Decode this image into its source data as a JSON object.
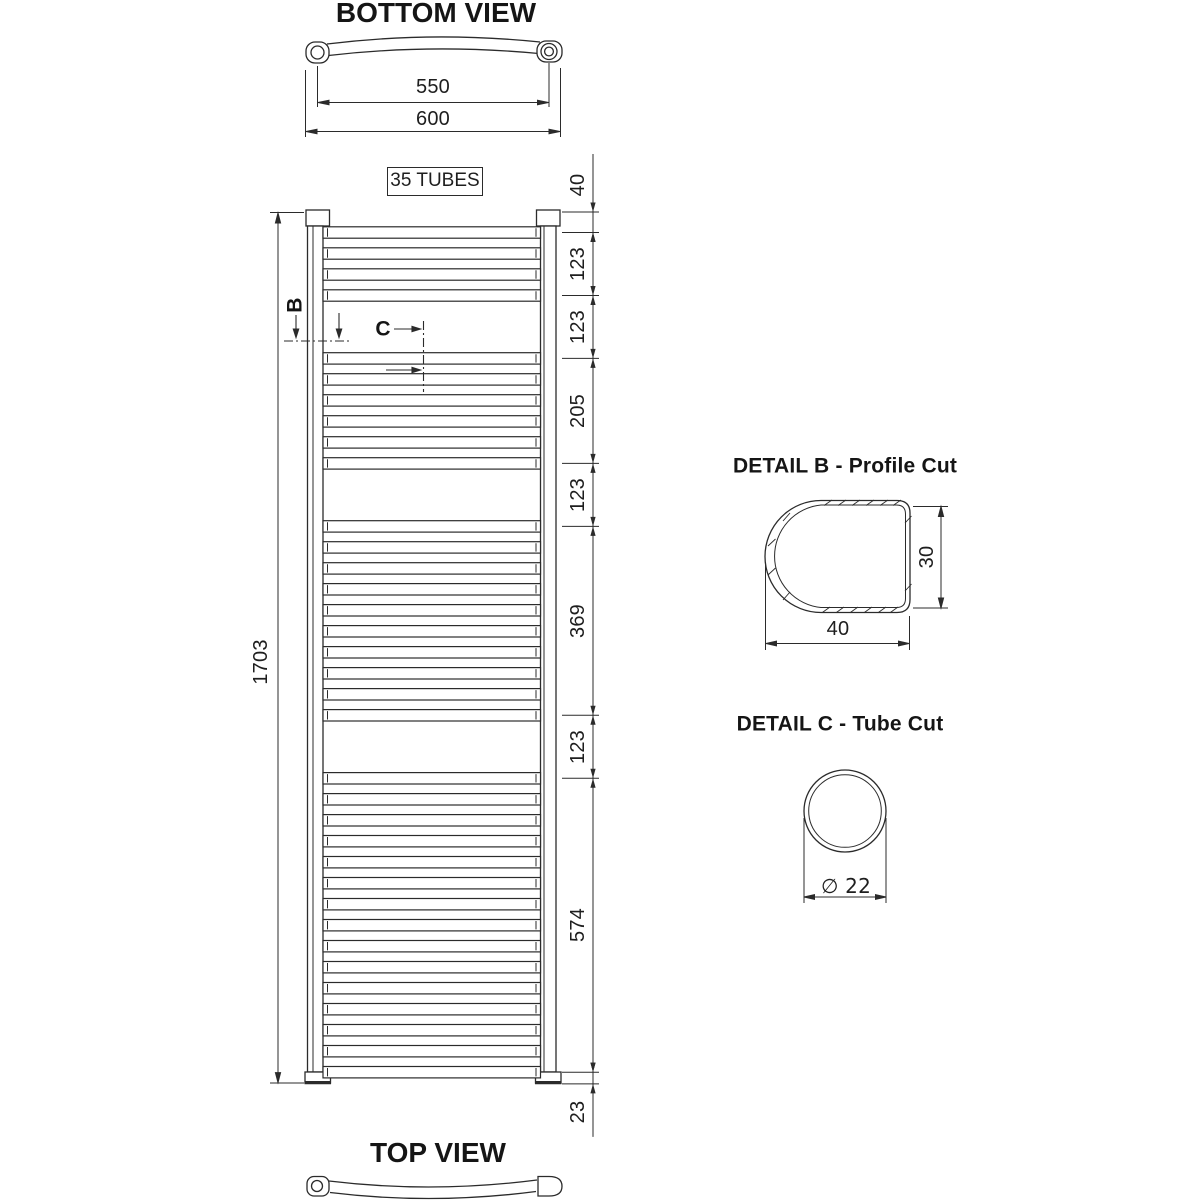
{
  "drawing": {
    "bottom_view": {
      "title": "BOTTOM VIEW",
      "dim_tube_centers": "550",
      "dim_overall_width": "600"
    },
    "front_view": {
      "tubes_count_label": "35 TUBES",
      "dim_overall_height": "1703",
      "dim_chain": [
        "40",
        "123",
        "123",
        "205",
        "123",
        "369",
        "123",
        "574",
        "23"
      ],
      "section_marker_b": "B",
      "section_marker_c": "C",
      "tube_groups": [
        {
          "start_mm": 40,
          "count": 4
        },
        {
          "start_mm": 286,
          "count": 6
        },
        {
          "start_mm": 614,
          "count": 10
        },
        {
          "start_mm": 1106,
          "count": 15
        }
      ],
      "tube_pitch_mm": 41
    },
    "detail_b": {
      "title": "DETAIL B - Profile Cut",
      "dim_profile_height": "30",
      "dim_profile_width": "40"
    },
    "detail_c": {
      "title": "DETAIL C - Tube Cut",
      "dim_tube_diameter": "∅ 22"
    },
    "top_view": {
      "title": "TOP VIEW"
    },
    "line_color": "#2b2b2b",
    "background": "#ffffff"
  }
}
